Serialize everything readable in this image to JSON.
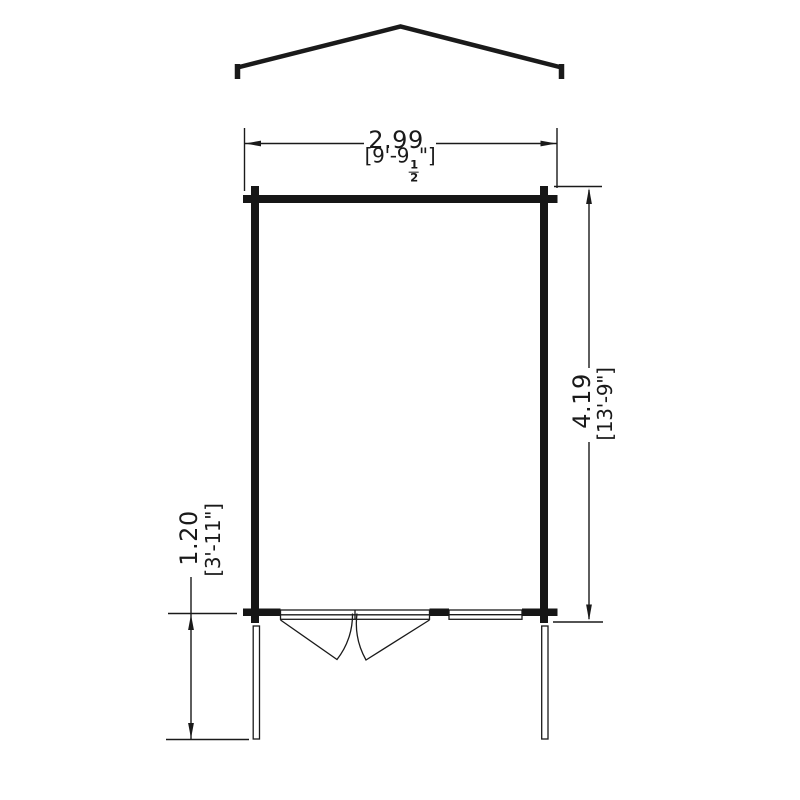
{
  "diagram": {
    "type": "log-cabin-floor-plan",
    "background_color": "#ffffff",
    "line_color": "#1a1a1a",
    "dimensions": {
      "width": {
        "metric": "2.99",
        "imperial_prefix": "[9'-9",
        "fraction_numerator": "1",
        "fraction_denominator": "2",
        "imperial_suffix": "\"]"
      },
      "depth": {
        "metric": "4.19",
        "imperial": "[13'-9\"]"
      },
      "veranda_depth": {
        "metric": "1.20",
        "imperial": "[3'-11\"]"
      }
    }
  }
}
